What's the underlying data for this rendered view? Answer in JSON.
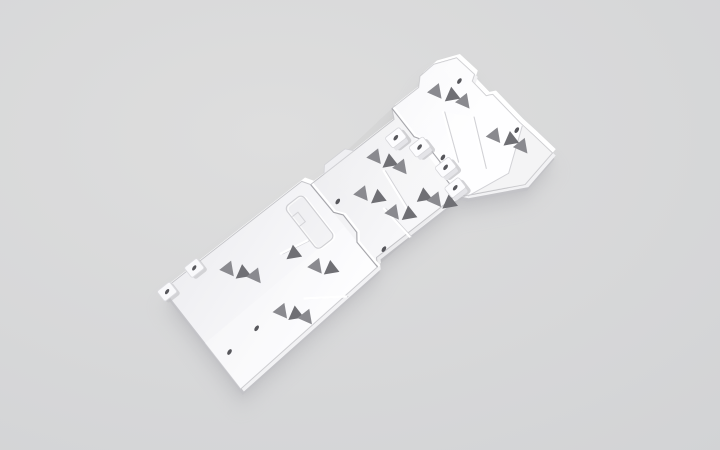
{
  "scene": {
    "type": "3d-product-render",
    "description": "White modular vehicle skid plate set (three linked underbody armor panels with triangular vent cutouts, mounting bosses and access hatch), rendered diagonally on a neutral light-gray studio background",
    "object": "skid-plate-assembly",
    "background": {
      "center": "#dedede",
      "edge": "#d2d3d5"
    },
    "shadow_color": "#b5b5b9"
  },
  "plate": {
    "colors": {
      "fill_base": "#eeeef1",
      "fill_light": "#fdfdff",
      "edge_dark": "#c3c3c7",
      "edge_white": "#ffffff",
      "edge_under": "#f2f2f4",
      "outline_line": "#c6c6ca",
      "seam": "#a6a6ab",
      "seam_highlight": "#ffffff",
      "detail_line": "#d2d2d6",
      "vent_dark": "#6f6f74",
      "vent_light": "#8a8a8f",
      "hole": "#57575c",
      "boss_top": "#fcfcfe",
      "boss_side": "#e4e4e8",
      "boss_shadow": "#bfbfc3",
      "pad_body": "#f9f9fb",
      "pad_stroke": "#dcdce0"
    },
    "transform": {
      "x": 200,
      "y": 337,
      "rotate": -38
    },
    "outline": [
      [
        0,
        -60
      ],
      [
        176,
        -60
      ],
      [
        181,
        -52
      ],
      [
        287,
        -52
      ],
      [
        292,
        -62
      ],
      [
        326,
        -62
      ],
      [
        334,
        -70
      ],
      [
        352,
        -71
      ],
      [
        374,
        -62
      ],
      [
        378,
        -38
      ],
      [
        372,
        -34
      ],
      [
        374,
        -14
      ],
      [
        380,
        -11
      ],
      [
        384,
        28
      ],
      [
        387,
        45
      ],
      [
        391,
        72
      ],
      [
        350,
        80
      ],
      [
        296,
        52
      ],
      [
        291,
        46
      ],
      [
        188,
        46
      ],
      [
        183,
        54
      ],
      [
        0,
        66
      ]
    ],
    "seams": [
      "M181,-52 L182,-16 L188,-8 L188,14 L182,22 L183,54",
      "M292,-62 L292,-26 L297,-18 L297,10 L291,18 L291,46"
    ],
    "hatch": {
      "x": 146,
      "y": -50,
      "w": 22,
      "h": 54,
      "r": 5
    },
    "hatch_step": "M146,-26 L154,-26 L154,-38 L147,-38",
    "vents": [
      {
        "x": 337,
        "y": -47,
        "d": "a",
        "t": "l"
      },
      {
        "x": 346,
        "y": -35,
        "d": "b",
        "t": "d"
      },
      {
        "x": 353,
        "y": -22,
        "d": "a",
        "t": "l"
      },
      {
        "x": 356,
        "y": 24,
        "d": "a",
        "t": "l"
      },
      {
        "x": 365,
        "y": 36,
        "d": "b",
        "t": "d"
      },
      {
        "x": 371,
        "y": 49,
        "d": "a",
        "t": "l"
      },
      {
        "x": 249,
        "y": -33,
        "d": "a",
        "t": "l"
      },
      {
        "x": 256,
        "y": -21,
        "d": "b",
        "t": "d"
      },
      {
        "x": 263,
        "y": -9,
        "d": "a",
        "t": "l"
      },
      {
        "x": 216,
        "y": -12,
        "d": "a",
        "t": "l"
      },
      {
        "x": 225,
        "y": 0,
        "d": "b",
        "t": "d"
      },
      {
        "x": 229,
        "y": 22,
        "d": "a",
        "t": "l"
      },
      {
        "x": 239,
        "y": 32,
        "d": "b",
        "t": "d"
      },
      {
        "x": 262,
        "y": 27,
        "d": "b",
        "t": "d"
      },
      {
        "x": 270,
        "y": 38,
        "d": "a",
        "t": "l"
      },
      {
        "x": 278,
        "y": 48,
        "d": "b",
        "t": "d"
      },
      {
        "x": 64,
        "y": -35,
        "d": "a",
        "t": "l"
      },
      {
        "x": 72,
        "y": -24,
        "d": "b",
        "t": "d"
      },
      {
        "x": 81,
        "y": -13,
        "d": "a",
        "t": "l"
      },
      {
        "x": 124,
        "y": -8,
        "d": "b",
        "t": "d"
      },
      {
        "x": 135,
        "y": 17,
        "d": "a",
        "t": "l"
      },
      {
        "x": 144,
        "y": 27,
        "d": "b",
        "t": "d"
      },
      {
        "x": 80,
        "y": 31,
        "d": "a",
        "t": "l"
      },
      {
        "x": 88,
        "y": 41,
        "d": "b",
        "t": "d"
      },
      {
        "x": 96,
        "y": 51,
        "d": "a",
        "t": "l"
      }
    ],
    "bosses": [
      [
        277,
        -34
      ],
      [
        290,
        -12
      ],
      [
        298,
        20
      ],
      [
        293,
        42
      ]
    ],
    "pads": [
      [
        2,
        -56
      ],
      [
        38,
        -58
      ]
    ],
    "holes": [
      [
        14,
        30
      ],
      [
        50,
        28
      ],
      [
        192,
        -22
      ],
      [
        199,
        44
      ],
      [
        302,
        8
      ],
      [
        362,
        -42
      ],
      [
        377,
        32
      ]
    ],
    "ribs": [
      [
        106,
        34,
        140,
        58
      ],
      [
        115,
        -16,
        144,
        -10
      ],
      [
        224,
        12,
        227,
        50
      ],
      [
        247,
        -18,
        242,
        26
      ],
      [
        330,
        -28,
        310,
        20
      ],
      [
        350,
        -6,
        328,
        42
      ]
    ],
    "flange_tab": [
      [
        198,
        -52
      ],
      [
        236,
        -52
      ],
      [
        230,
        -59
      ],
      [
        204,
        -59
      ]
    ],
    "front_flap": [
      [
        384,
        32
      ],
      [
        387,
        45
      ],
      [
        391,
        72
      ],
      [
        350,
        80
      ],
      [
        298,
        54
      ],
      [
        344,
        61
      ]
    ],
    "fold_line": "M384,32 L344,61 L298,54",
    "shade_mid": [
      [
        181,
        -52
      ],
      [
        292,
        -62
      ],
      [
        291,
        46
      ],
      [
        183,
        54
      ]
    ],
    "shade_rear_bright": [
      [
        0,
        8
      ],
      [
        181,
        2
      ],
      [
        183,
        54
      ],
      [
        0,
        66
      ]
    ],
    "shade_front_strip": [
      [
        330,
        -28
      ],
      [
        350,
        -6
      ],
      [
        328,
        42
      ],
      [
        310,
        20
      ]
    ]
  }
}
